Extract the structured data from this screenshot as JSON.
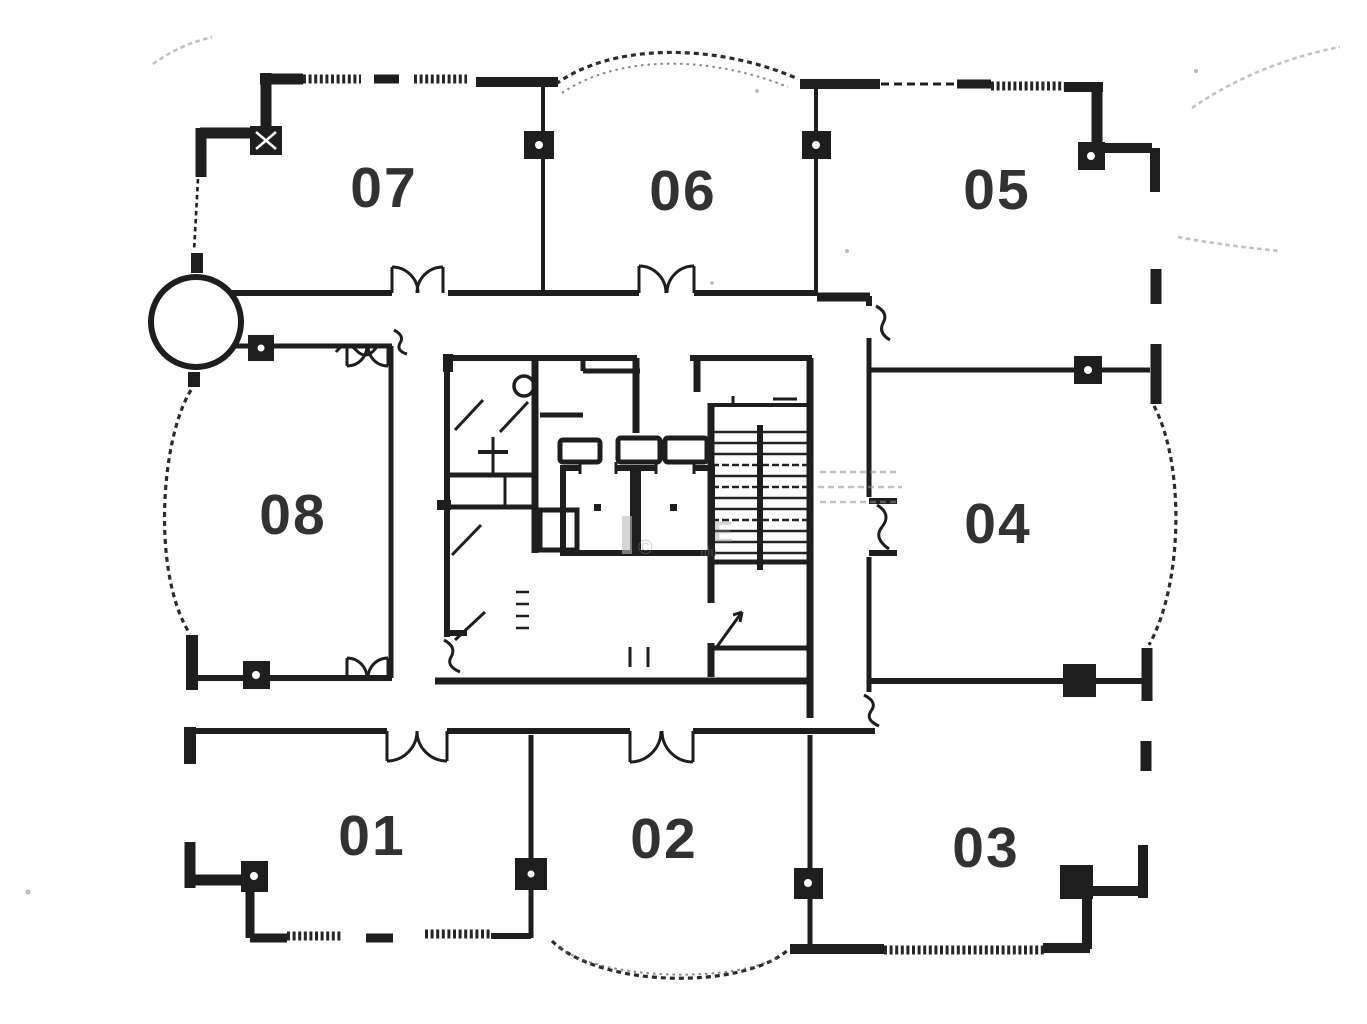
{
  "plan": {
    "type": "floor-plan-scan",
    "units": [
      {
        "id": "07"
      },
      {
        "id": "06"
      },
      {
        "id": "05"
      },
      {
        "id": "08"
      },
      {
        "id": "04"
      },
      {
        "id": "01"
      },
      {
        "id": "02"
      },
      {
        "id": "03"
      }
    ],
    "watermark": {
      "fragments": [
        "E",
        "©",
        "ıılıı"
      ]
    },
    "colors": {
      "ink": "#1e1e1e",
      "paper": "#ffffff",
      "faint_ink": "#8f8f8f",
      "watermark_gray": "#bbbbbb"
    }
  }
}
